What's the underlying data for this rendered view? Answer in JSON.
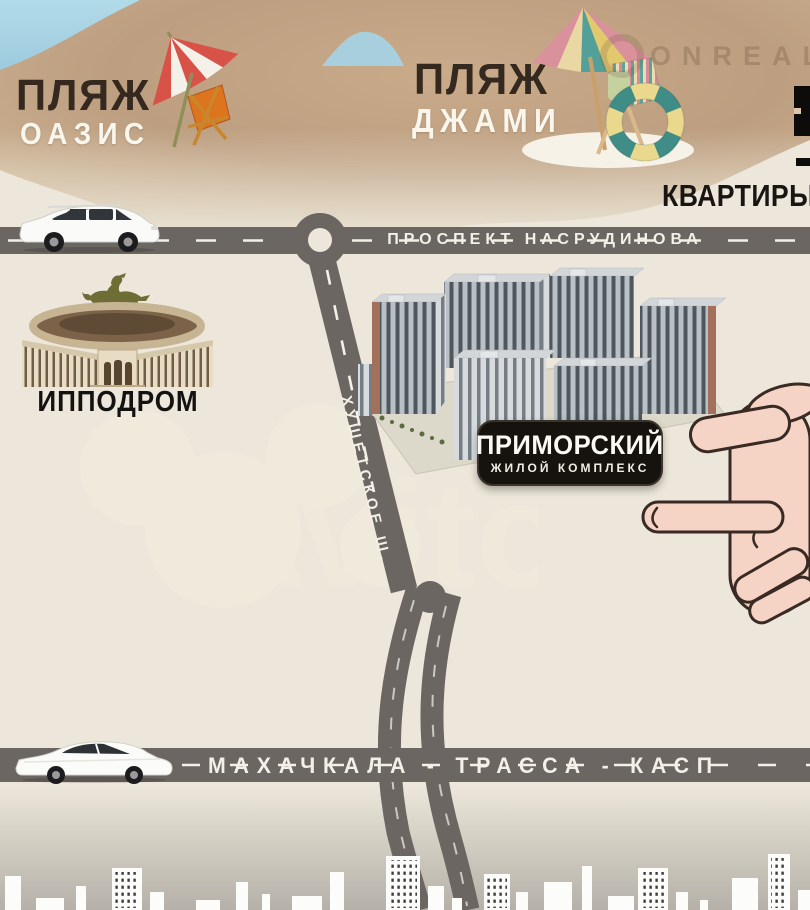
{
  "landmarks": {
    "beach_oasis": {
      "title": "ПЛЯЖ",
      "name": "ОАЗИС"
    },
    "beach_dzhami": {
      "title": "ПЛЯЖ",
      "name": "ДЖАМИ"
    },
    "hippodrome": {
      "label": "ИППОДРОМ"
    },
    "complex": {
      "name": "ПРИМОРСКИЙ",
      "subtitle": "ЖИЛОЙ КОМПЛЕКС"
    }
  },
  "roads": {
    "avenue": {
      "label": "ПРОСПЕКТ НАСРУДИНОВА"
    },
    "highway": {
      "label": "ХУШЕТСКОЕ Ш."
    },
    "trassa": {
      "label": "МАХАЧКАЛА - ТРАССА - КАСП"
    }
  },
  "header": {
    "listing_type": "КВАРТИРЫ"
  },
  "watermarks": {
    "agency": "ONREALT",
    "platform": "Avito"
  },
  "colors": {
    "sky": "#a7d1e1",
    "sand": "#bfa183",
    "cream": "#ece7da",
    "road": "#6b6661",
    "road_line": "#f3f0e8",
    "label_bg": "#16130f",
    "skin": "#f5d3c5",
    "umbrella_red": "#d85248",
    "chair_orange": "#dd741e",
    "horse": "#6d6d35"
  },
  "icons": {
    "beach_umbrella_red": "red-white striped parasol",
    "deck_chair_orange": "orange deck chair",
    "beach_umbrella_multi": "multicolor parasol",
    "striped_deck_chair": "striped deck chair",
    "lifebuoy": "teal-yellow life ring",
    "suv_car": "white SUV",
    "sedan_car": "white sedan",
    "horse_rider": "horse with jockey silhouette",
    "stadium": "hippodrome grandstand",
    "apartment_complex_3d": "3D render of residential blocks",
    "pointing_hand": "hand pointing at complex",
    "city_skyline": "white city silhouette"
  }
}
